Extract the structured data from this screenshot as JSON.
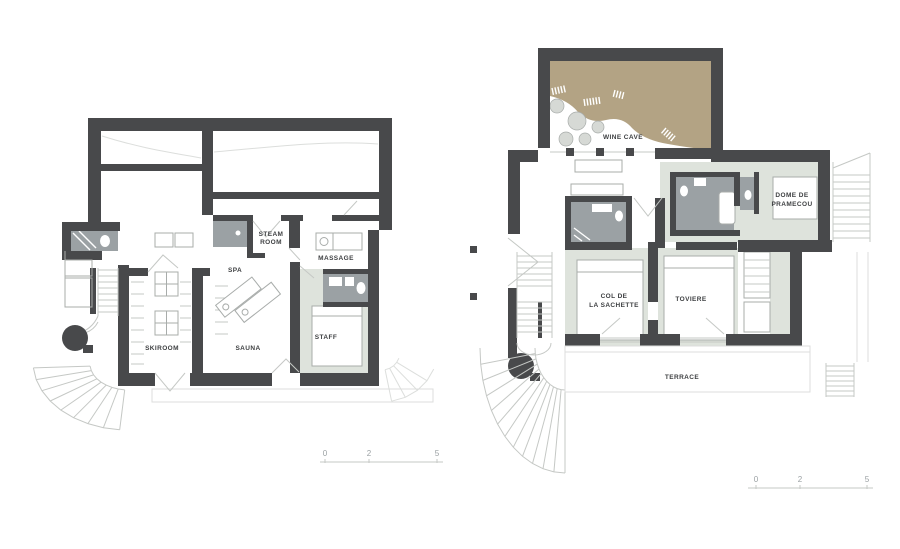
{
  "colors": {
    "wall": "#48494b",
    "room_fill": "#dee3dc",
    "bath_fill": "#9ba1a4",
    "wine_fill": "#b3a384",
    "boulder_fill": "#d6d9d5",
    "line_light": "#c5c8c5",
    "line_mid": "#a8acaa",
    "line_faint": "#dcdedc",
    "label_text": "#3d3f41",
    "scale_text": "#9aa0a3",
    "background": "#ffffff"
  },
  "left_plan": {
    "rooms": {
      "skiroom": {
        "label": "SKIROOM"
      },
      "sauna": {
        "label": "SAUNA"
      },
      "spa": {
        "label": "SPA"
      },
      "steam_room": {
        "line1": "STEAM",
        "line2": "ROOM"
      },
      "massage": {
        "label": "MASSAGE"
      },
      "staff": {
        "label": "STAFF"
      }
    },
    "scale_bar": {
      "ticks": [
        "0",
        "2",
        "5"
      ]
    }
  },
  "right_plan": {
    "rooms": {
      "wine_cave": {
        "label": "WINE CAVE"
      },
      "dome_de_pramecou": {
        "line1": "DOME DE",
        "line2": "PRAMECOU"
      },
      "col_de_la_sachette": {
        "line1": "COL DE",
        "line2": "LA SACHETTE"
      },
      "toviere": {
        "label": "TOVIERE"
      },
      "terrace": {
        "label": "TERRACE"
      }
    },
    "scale_bar": {
      "ticks": [
        "0",
        "2",
        "5"
      ]
    }
  }
}
